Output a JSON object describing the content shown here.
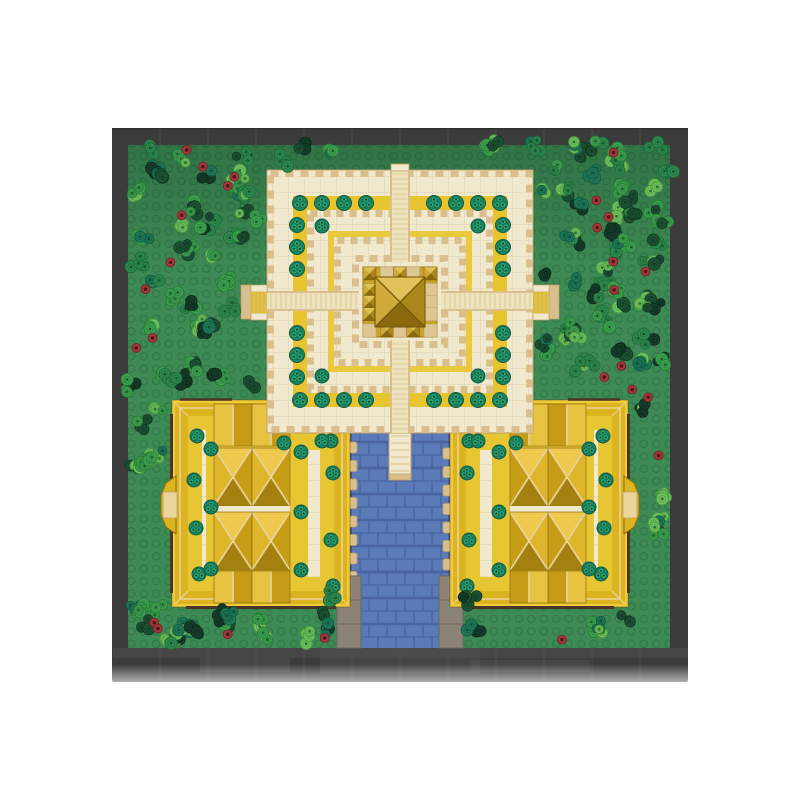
{
  "image_type": "product-photo",
  "subject": "Top-down aerial view of a LEGO brick temple model (stepped pyramid sanctuary with two golden courtyard halls, a blue tiled causeway and a tree-covered green baseplate) photographed on a white background",
  "canvas": {
    "width": 800,
    "height": 800,
    "background": "#ffffff"
  },
  "palette": {
    "plate": "#3b3b3b",
    "plate_seam": "#4f4f4f",
    "plate_sheen": "#515151",
    "plate_shadow": "#2f2f2f",
    "grass": "#3e8a55",
    "grass_stud": "rgba(0,30,12,0.16)",
    "grass_shade": "rgba(0,35,15,0.20)",
    "cream": "#f1e9cd",
    "cream_line": "rgba(160,135,80,0.25)",
    "tan": "#d9be8e",
    "tan_dark": "#c1a066",
    "gold_band": "#e8c52e",
    "court_wall": "#f0cc3a",
    "court_roof": "#dcb41f",
    "court_floor_gold": "#e7c633",
    "roof_ridge": "#e9d49b",
    "roof_n": "#eec94d",
    "roof_w": "#ddb62c",
    "roof_e": "#c79d18",
    "roof_s": "#a3800f",
    "gable_l": "#e8c342",
    "gable_r": "#c69b16",
    "roof_edge": "#8f6e0c",
    "shrine_base": "#c9a32a",
    "shrine_edge": "#a07e14",
    "facet_n": "#e0c258",
    "facet_w": "#cfa93a",
    "facet_e": "#ab861b",
    "facet_s": "#8a690e",
    "facet_line": "#6e5408",
    "water": "#5b7ab8",
    "water_mortar": "#47619b",
    "water_shadow": "rgba(20,30,60,0.40)",
    "stone": "#8b8375",
    "stone_line": "#6e675b",
    "beam": "#4a3526",
    "bush_base": "#1d8560",
    "bush_lobe": "#27a072",
    "bush_stroke": "#135c43",
    "bush_dot": "#0b3826",
    "red_flower": "#a23a3c",
    "red_flower_dark": "#772628",
    "red_flower_dot": "#4f1517"
  },
  "baseplate": {
    "rect": [
      112,
      128,
      576,
      554
    ],
    "seam_xs": [
      160,
      208,
      256,
      304,
      352,
      400,
      448,
      496,
      544,
      592,
      640
    ],
    "reflections": [
      [
        113,
        648,
        575,
        10
      ],
      [
        320,
        648,
        160,
        26
      ],
      [
        200,
        658,
        90,
        14
      ],
      [
        470,
        660,
        120,
        12
      ]
    ],
    "fade_rect": [
      96,
      664,
      608,
      40
    ]
  },
  "field": {
    "rect": [
      128,
      145,
      542,
      503
    ],
    "stud_spacing": 12.5
  },
  "plants": {
    "seed": 11,
    "cluster_count": 128,
    "red_count": 26,
    "greens": [
      "#6fc45e",
      "#3da24f",
      "#2e8b4e",
      "#1d5435",
      "#1f7a5a",
      "#173f2b"
    ],
    "greens_dark": [
      "#4f9a41",
      "#2b7d3a",
      "#206b3a",
      "#123a24",
      "#145c42",
      "#0d2a1c"
    ],
    "weights": [
      0.18,
      0.22,
      0.2,
      0.16,
      0.14,
      0.1
    ],
    "bounds": [
      131,
      144,
      666,
      642
    ],
    "exclusions": [
      [
        262,
        164,
        276,
        274
      ],
      [
        166,
        395,
        190,
        214
      ],
      [
        444,
        395,
        190,
        214
      ],
      [
        344,
        420,
        112,
        230
      ],
      [
        240,
        280,
        32,
        44
      ],
      [
        528,
        280,
        32,
        44
      ],
      [
        152,
        472,
        28,
        66
      ],
      [
        620,
        472,
        28,
        66
      ]
    ],
    "extra_clusters": [
      [
        330,
        598
      ],
      [
        327,
        628
      ],
      [
        470,
        598
      ],
      [
        473,
        628
      ],
      [
        150,
        146
      ],
      [
        305,
        143
      ],
      [
        490,
        144
      ],
      [
        600,
        147
      ]
    ]
  },
  "water": {
    "rect": [
      350,
      428,
      100,
      220
    ],
    "pier": [
      389,
      428,
      22,
      52
    ],
    "tab_y_start": 442,
    "tab_y_end": 574,
    "tab_step": 18.5,
    "stones": [
      [
        337,
        576,
        24,
        72
      ],
      [
        439,
        576,
        24,
        72
      ]
    ]
  },
  "pyramid": {
    "rect": [
      267,
      170,
      266,
      263
    ],
    "teeth1_inset": 3.5,
    "yellow_ring": [
      300,
      203,
      200,
      197,
      14
    ],
    "teeth2": [
      310.5,
      213.5,
      179,
      176
    ],
    "sliver_ring": [
      331,
      234,
      138,
      135,
      6
    ],
    "teeth3": [
      337.5,
      240.5,
      125,
      122
    ],
    "teeth4": [
      355.5,
      258.5,
      89,
      86
    ],
    "stairs": {
      "n": [
        390,
        170,
        20,
        92
      ],
      "s": [
        390,
        340,
        20,
        93
      ],
      "w": [
        267,
        291,
        92,
        20
      ],
      "e": [
        441,
        291,
        92,
        20
      ]
    },
    "n_tab": [
      391,
      164,
      18,
      7
    ],
    "arm_w": {
      "tip": [
        241,
        285,
        10,
        34
      ],
      "rails": [
        [
          251,
          285,
          16,
          7
        ],
        [
          251,
          313,
          16,
          7
        ]
      ],
      "steps": [
        251,
        292,
        16,
        21
      ]
    },
    "arm_e": {
      "tip": [
        549,
        285,
        10,
        34
      ],
      "rails": [
        [
          533,
          285,
          16,
          7
        ],
        [
          533,
          313,
          16,
          7
        ]
      ],
      "steps": [
        533,
        292,
        16,
        21
      ]
    },
    "ring_trees": {
      "row_xs": [
        300,
        322,
        344,
        366,
        434,
        456,
        478,
        500
      ],
      "row_ys": [
        203,
        400
      ],
      "col_ys": [
        225,
        247,
        269,
        333,
        355,
        377
      ],
      "col_xs": [
        297,
        503
      ],
      "inner": [
        [
          322,
          226
        ],
        [
          478,
          226
        ],
        [
          322,
          376
        ],
        [
          478,
          376
        ]
      ]
    },
    "shrine": {
      "base": [
        363,
        267,
        74,
        70
      ],
      "big": [
        375,
        277,
        50,
        50
      ],
      "piece": 13
    }
  },
  "courtyard": {
    "left_rect": [
      172,
      400,
      178,
      207
    ],
    "mirror_width": 800,
    "gallery_w": 16,
    "column": {
      "x": 214,
      "w": 76,
      "gable_n": [
        404,
        42
      ],
      "hip1": [
        448,
        58
      ],
      "hip2": [
        512,
        58
      ],
      "gable_s": [
        571,
        32
      ]
    },
    "ne_patch": [
      262,
      430,
      72,
      20
    ],
    "inner_strip": [
      294,
      430,
      14,
      147
    ],
    "bushes": [
      [
        197,
        436
      ],
      [
        194,
        480
      ],
      [
        196,
        528
      ],
      [
        199,
        574
      ],
      [
        301,
        452
      ],
      [
        301,
        512
      ],
      [
        301,
        570
      ],
      [
        331,
        441
      ],
      [
        333,
        473
      ],
      [
        331,
        540
      ],
      [
        333,
        586
      ],
      [
        211,
        449
      ],
      [
        211,
        507
      ],
      [
        211,
        569
      ],
      [
        284,
        443
      ],
      [
        322,
        441
      ]
    ],
    "gate": {
      "wall_x": 176,
      "pts": [
        [
          176,
          476
        ],
        [
          166,
          483
        ],
        [
          161,
          495
        ],
        [
          161,
          515
        ],
        [
          166,
          527
        ],
        [
          176,
          534
        ]
      ],
      "roof": [
        163,
        492,
        14,
        26
      ]
    }
  }
}
